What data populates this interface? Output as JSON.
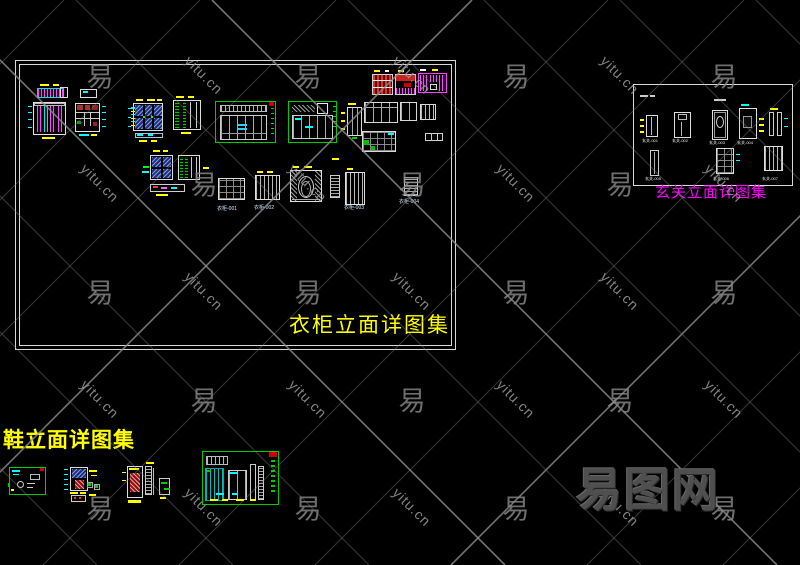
{
  "canvas": {
    "width": 800,
    "height": 565,
    "background": "#000000"
  },
  "collections": {
    "wardrobe": {
      "title": "衣柜立面详图集",
      "labels": [
        "衣柜-001",
        "衣柜-002",
        "衣柜-003",
        "衣柜-004"
      ]
    },
    "entry": {
      "title": "玄关立面详图集",
      "labels": [
        "玄关-001",
        "玄关-002",
        "玄关-003",
        "玄关-004",
        "玄关-005",
        "玄关-006",
        "玄关-007"
      ]
    },
    "shoe": {
      "title": "鞋立面详图集"
    }
  },
  "watermark": {
    "site_text": "yitu.cn",
    "brand_char": "易",
    "logo_text": "易图网"
  },
  "colors": {
    "title_yellow": "#ffff00",
    "title_magenta": "#ff00ff",
    "cad_white": "#e0e0e0",
    "cad_green": "#00cc00",
    "cad_cyan": "#00ffff",
    "cad_red": "#cc0000",
    "cad_magenta": "#ff40ff",
    "watermark_gray": "#8c8c8c",
    "logo_gray": "#4f4f4f"
  }
}
